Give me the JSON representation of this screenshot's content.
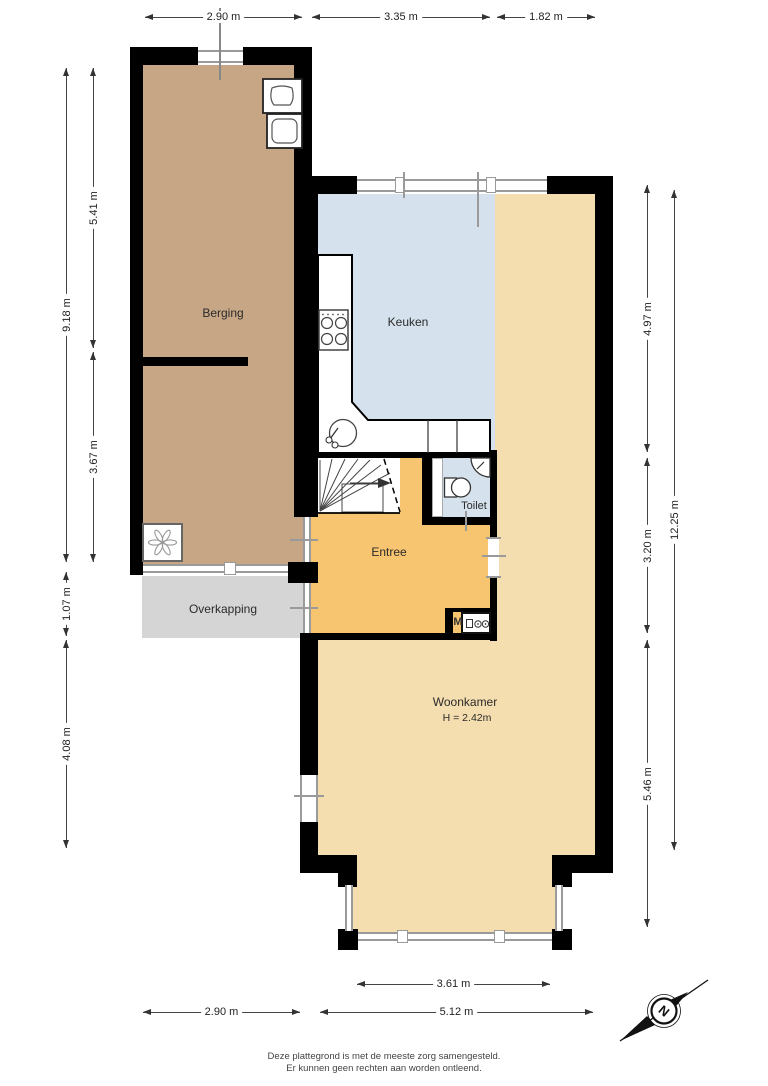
{
  "rooms": {
    "berging": "Berging",
    "keuken": "Keuken",
    "toilet": "Toilet",
    "entree": "Entree",
    "overkapping": "Overkapping",
    "woonkamer": "Woonkamer",
    "woonkamer_ceiling_height": "H = 2.42m",
    "meter_cupboard": "M"
  },
  "dimensions": {
    "top": [
      "2.90 m",
      "3.35 m",
      "1.82 m"
    ],
    "bottom_bay": "3.61 m",
    "bottom": [
      "2.90 m",
      "5.12 m"
    ],
    "left_outer": [
      "9.18 m",
      "1.07 m",
      "4.08 m"
    ],
    "left_inner": [
      "5.41 m",
      "3.67 m"
    ],
    "right_inner": [
      "4.97 m",
      "3.20 m",
      "5.46 m"
    ],
    "right_outer": "12.25 m"
  },
  "compass": {
    "north_label": "N"
  },
  "footer": {
    "line1": "Deze plattegrond is met de meeste zorg samengesteld.",
    "line2": "Er kunnen geen rechten aan worden ontleend."
  },
  "icons": {
    "compass-rose-icon": "north arrow",
    "stove-icon": "4-burner hob",
    "sink-icon": "round kitchen sink with tap",
    "toilet-icon": "toilet bowl",
    "corner-basin-icon": "corner hand basin",
    "washer-icon": "appliance box",
    "utility-sink-icon": "utility fixture box",
    "ventilation-fan-icon": "mechanical ventilation unit",
    "electric-meter-icon": "meter box",
    "stairs-icon": "winder staircase with up arrow"
  },
  "colors": {
    "wall": "#000000",
    "berging": "#c6a685",
    "keuken": "#d5e2ed",
    "toilet": "#d5e2ed",
    "entree": "#f7c470",
    "woonkamer": "#f4ddae",
    "overkapping": "#d5d5d5",
    "glass_frame": "#9a9a9a",
    "dimension_line": "#333333"
  }
}
